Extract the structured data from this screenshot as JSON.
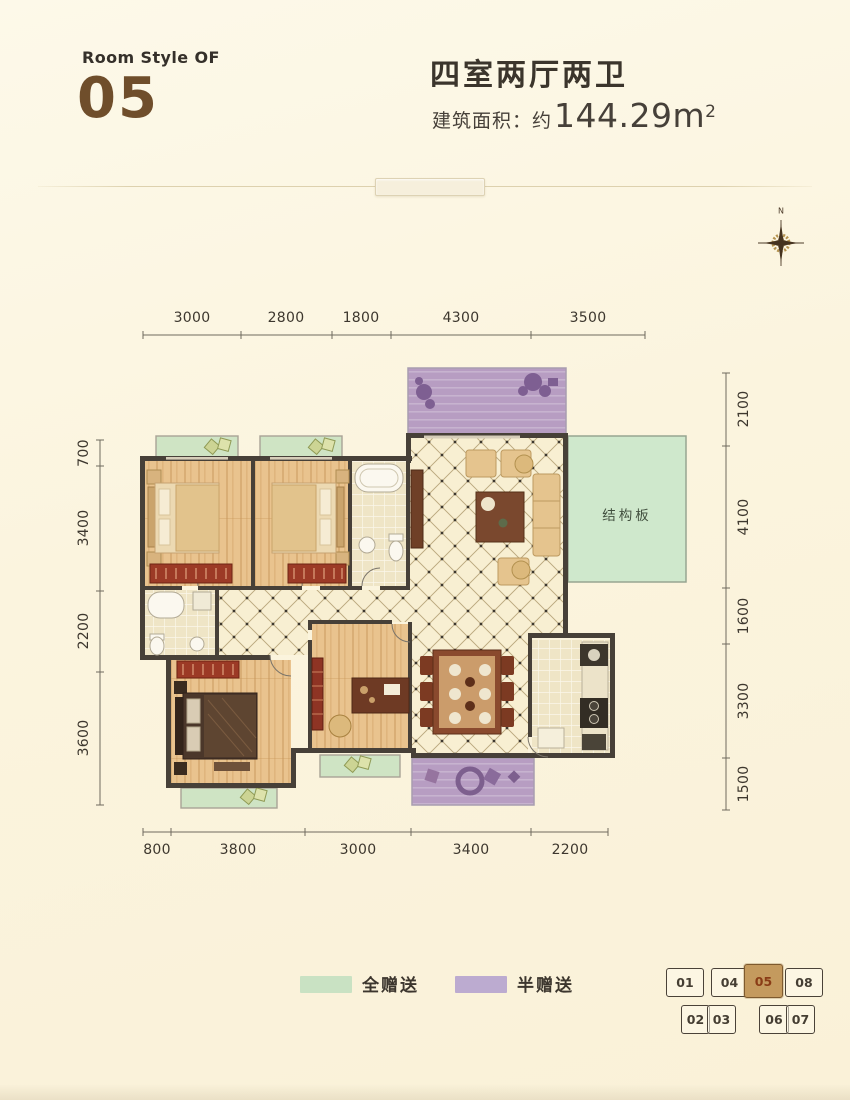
{
  "header": {
    "room_style_label": "Room Style OF",
    "room_number": "05",
    "title": "四室两厅两卫",
    "area_label": "建筑面积：",
    "area_approx": "约",
    "area_value": "144.29m",
    "area_sup": "2"
  },
  "compass": {
    "north_label": "N"
  },
  "plan": {
    "slab_label": "结构板",
    "dimensions": {
      "top": [
        "3000",
        "2800",
        "1800",
        "4300",
        "3500"
      ],
      "bottom": [
        "800",
        "3800",
        "3000",
        "3400",
        "2200"
      ],
      "left": [
        "700",
        "3400",
        "2200",
        "3600"
      ],
      "right": [
        "2100",
        "4100",
        "1600",
        "3300",
        "1500"
      ]
    }
  },
  "legend": {
    "items": [
      {
        "label": "全赠送",
        "color": "#c9e2c3"
      },
      {
        "label": "半赠送",
        "color": "#bcabd0"
      }
    ]
  },
  "key_plan": {
    "highlighted_unit": "05",
    "highlight_color": "#c49a5e",
    "top_row": [
      "01",
      "04",
      "05",
      "08"
    ],
    "bottom_row": [
      "02",
      "03",
      "06",
      "07"
    ]
  }
}
